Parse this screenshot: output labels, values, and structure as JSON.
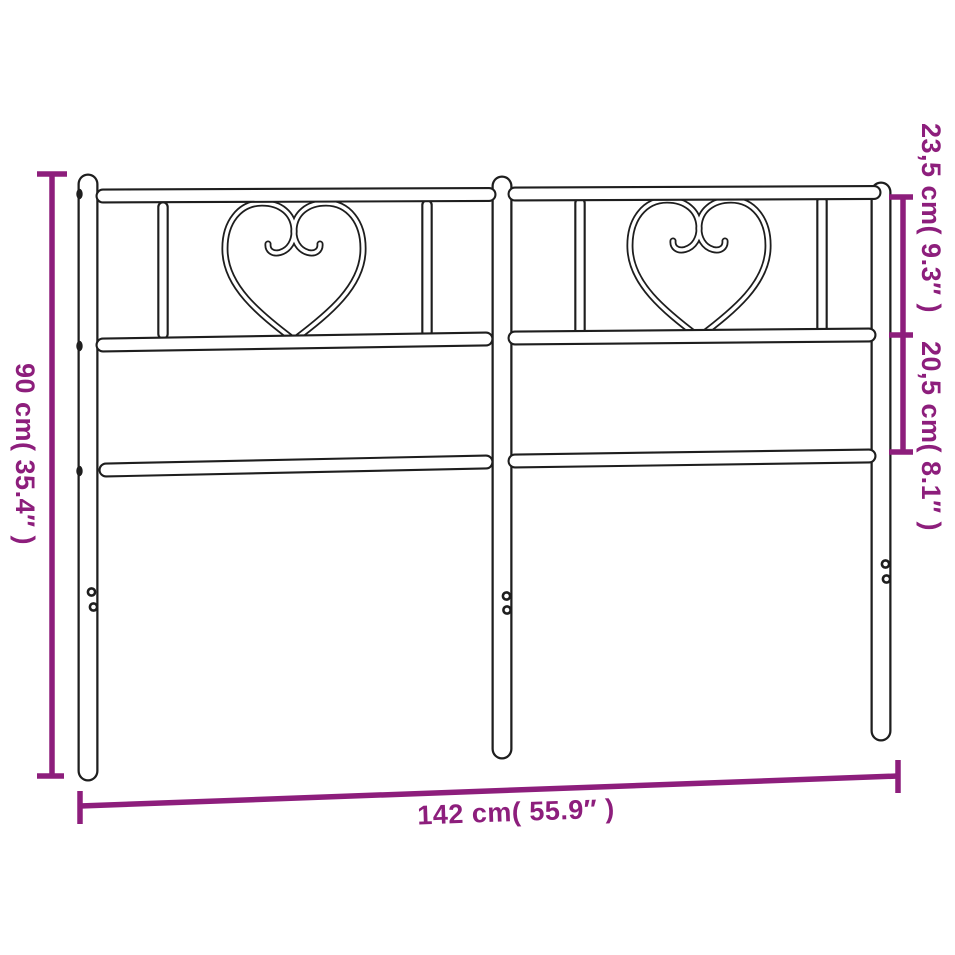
{
  "diagram": {
    "type": "product-dimension-diagram",
    "subject": "metal headboard with heart scroll ornaments",
    "background_color": "#ffffff",
    "line_color": "#1e1e1e",
    "accent_color": "#8d1e7c",
    "dimensions": {
      "overall_height": {
        "cm": 90,
        "inches": 35.4,
        "label": "90 cm( 35.4″ )"
      },
      "top_section_height": {
        "cm": 23.5,
        "inches": 9.3,
        "label": "23,5 cm( 9.3″ )"
      },
      "middle_section_height": {
        "cm": 20.5,
        "inches": 8.1,
        "label": "20,5 cm( 8.1″ )"
      },
      "overall_width": {
        "cm": 142,
        "inches": 55.9,
        "label": "142 cm( 55.9″ )"
      }
    }
  }
}
